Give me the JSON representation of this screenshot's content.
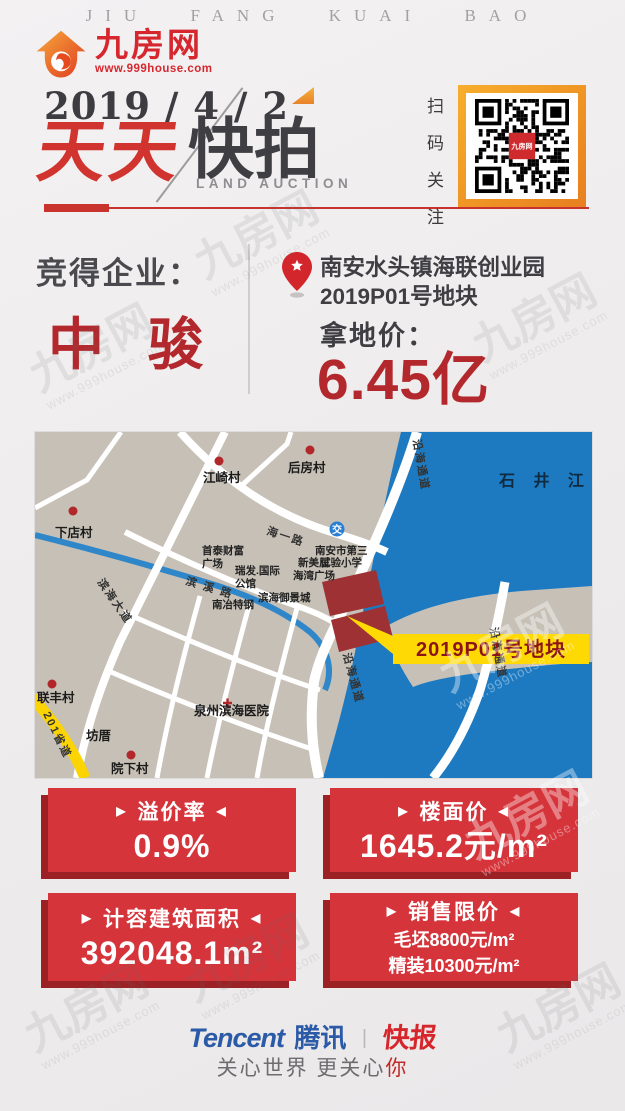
{
  "masthead": {
    "tagline": "JIU FANG KUAI BAO"
  },
  "logo": {
    "name": "九房网",
    "url": "www.999house.com"
  },
  "header": {
    "date": "2019 / 4 / 2",
    "title_red": "天天",
    "title_dark": "快拍",
    "subtitle": "LAND AUCTION"
  },
  "qr": {
    "caption_chars": [
      "扫",
      "码",
      "关",
      "注"
    ],
    "center_label": "九房网"
  },
  "winner": {
    "label": "竞得企业：",
    "name": "中 骏"
  },
  "parcel": {
    "location_line1": "南安水头镇海联创业园",
    "location_line2": "2019P01号地块",
    "price_label": "拿地价：",
    "price_value": "6.45亿"
  },
  "map": {
    "labels": [
      {
        "t": "石 井 江",
        "x": 464,
        "y": 54,
        "cls": "water"
      },
      {
        "t": "江崎村",
        "x": 168,
        "y": 50,
        "cls": "village"
      },
      {
        "t": "后房村",
        "x": 253,
        "y": 40,
        "cls": "village"
      },
      {
        "t": "下店村",
        "x": 20,
        "y": 105,
        "cls": "village"
      },
      {
        "t": "联丰村",
        "x": 2,
        "y": 270,
        "cls": "village"
      },
      {
        "t": "坊厝",
        "x": 51,
        "y": 308,
        "cls": "village"
      },
      {
        "t": "院下村",
        "x": 76,
        "y": 341,
        "cls": "village"
      },
      {
        "t": "泉州滨海医院",
        "x": 159,
        "y": 283,
        "cls": "village"
      },
      {
        "t": "南冶特钢",
        "x": 177,
        "y": 176,
        "cls": "poi"
      },
      {
        "t": "滨海御景城",
        "x": 223,
        "y": 169,
        "cls": "poi"
      },
      {
        "t": "首泰财富",
        "x": 167,
        "y": 122,
        "cls": "poi"
      },
      {
        "t": "广场",
        "x": 167,
        "y": 135,
        "cls": "poi"
      },
      {
        "t": "瑞发.国际",
        "x": 200,
        "y": 142,
        "cls": "poi"
      },
      {
        "t": "公馆",
        "x": 200,
        "y": 155,
        "cls": "poi"
      },
      {
        "t": "新美居",
        "x": 263,
        "y": 134,
        "cls": "poi"
      },
      {
        "t": "海湾广场",
        "x": 258,
        "y": 147,
        "cls": "poi"
      },
      {
        "t": "南安市第三",
        "x": 280,
        "y": 122,
        "cls": "poi"
      },
      {
        "t": "试验小学",
        "x": 285,
        "y": 134,
        "cls": "poi"
      },
      {
        "t": "交",
        "x": 302,
        "y": 101,
        "cls": "school",
        "a": "m"
      },
      {
        "t": "海一路",
        "x": 231,
        "y": 102,
        "cls": "road",
        "r": 18
      },
      {
        "t": "滨 溪 路",
        "x": 150,
        "y": 152,
        "cls": "road",
        "r": 17
      },
      {
        "t": "滨海大道",
        "x": 62,
        "y": 150,
        "cls": "road",
        "r": 55
      },
      {
        "t": "沿海通道",
        "x": 378,
        "y": 8,
        "cls": "road",
        "r": 80
      },
      {
        "t": "沿海通道",
        "x": 308,
        "y": 222,
        "cls": "road",
        "r": 75
      },
      {
        "t": "沿海通道",
        "x": 455,
        "y": 196,
        "cls": "road",
        "r": 80
      },
      {
        "t": "201省道",
        "x": 8,
        "y": 282,
        "cls": "road",
        "r": 64
      },
      {
        "t": "2019P01号地块",
        "x": 456,
        "y": 224,
        "cls": "callout",
        "a": "m"
      }
    ],
    "dots": [
      {
        "x": 184,
        "y": 29
      },
      {
        "x": 275,
        "y": 18
      },
      {
        "x": 38,
        "y": 79
      },
      {
        "x": 17,
        "y": 252
      },
      {
        "x": 96,
        "y": 323
      }
    ]
  },
  "cards": [
    {
      "title": "溢价率",
      "value": "0.9%"
    },
    {
      "title": "楼面价",
      "value": "1645.2元/m²"
    },
    {
      "title": "计容建筑面积",
      "value": "392048.1m²"
    },
    {
      "title": "销售限价",
      "lines": [
        "毛坯8800元/m²",
        "精装10300元/m²"
      ]
    }
  ],
  "ui": {
    "marker_left": "▶",
    "marker_right": "◀"
  },
  "footer": {
    "tencent_en": "Tencent",
    "tencent_cn": "腾讯",
    "separator": "|",
    "kuaibao": "快报",
    "slogan_main": "关心世界 更关心",
    "slogan_accent": "你"
  },
  "watermark": {
    "text": "九房网",
    "subtext": "www.999house.com"
  },
  "colors": {
    "accent_red": "#c8332e",
    "card_red": "#d5343b",
    "card_shadow": "#9b2125",
    "crimson": "#b3282c",
    "water_blue": "#1d7ac1",
    "land_beige": "#c7c0b6",
    "callout_yellow": "#ffd903",
    "tencent_blue": "#2b5aa7",
    "orange": "#f0952d"
  }
}
